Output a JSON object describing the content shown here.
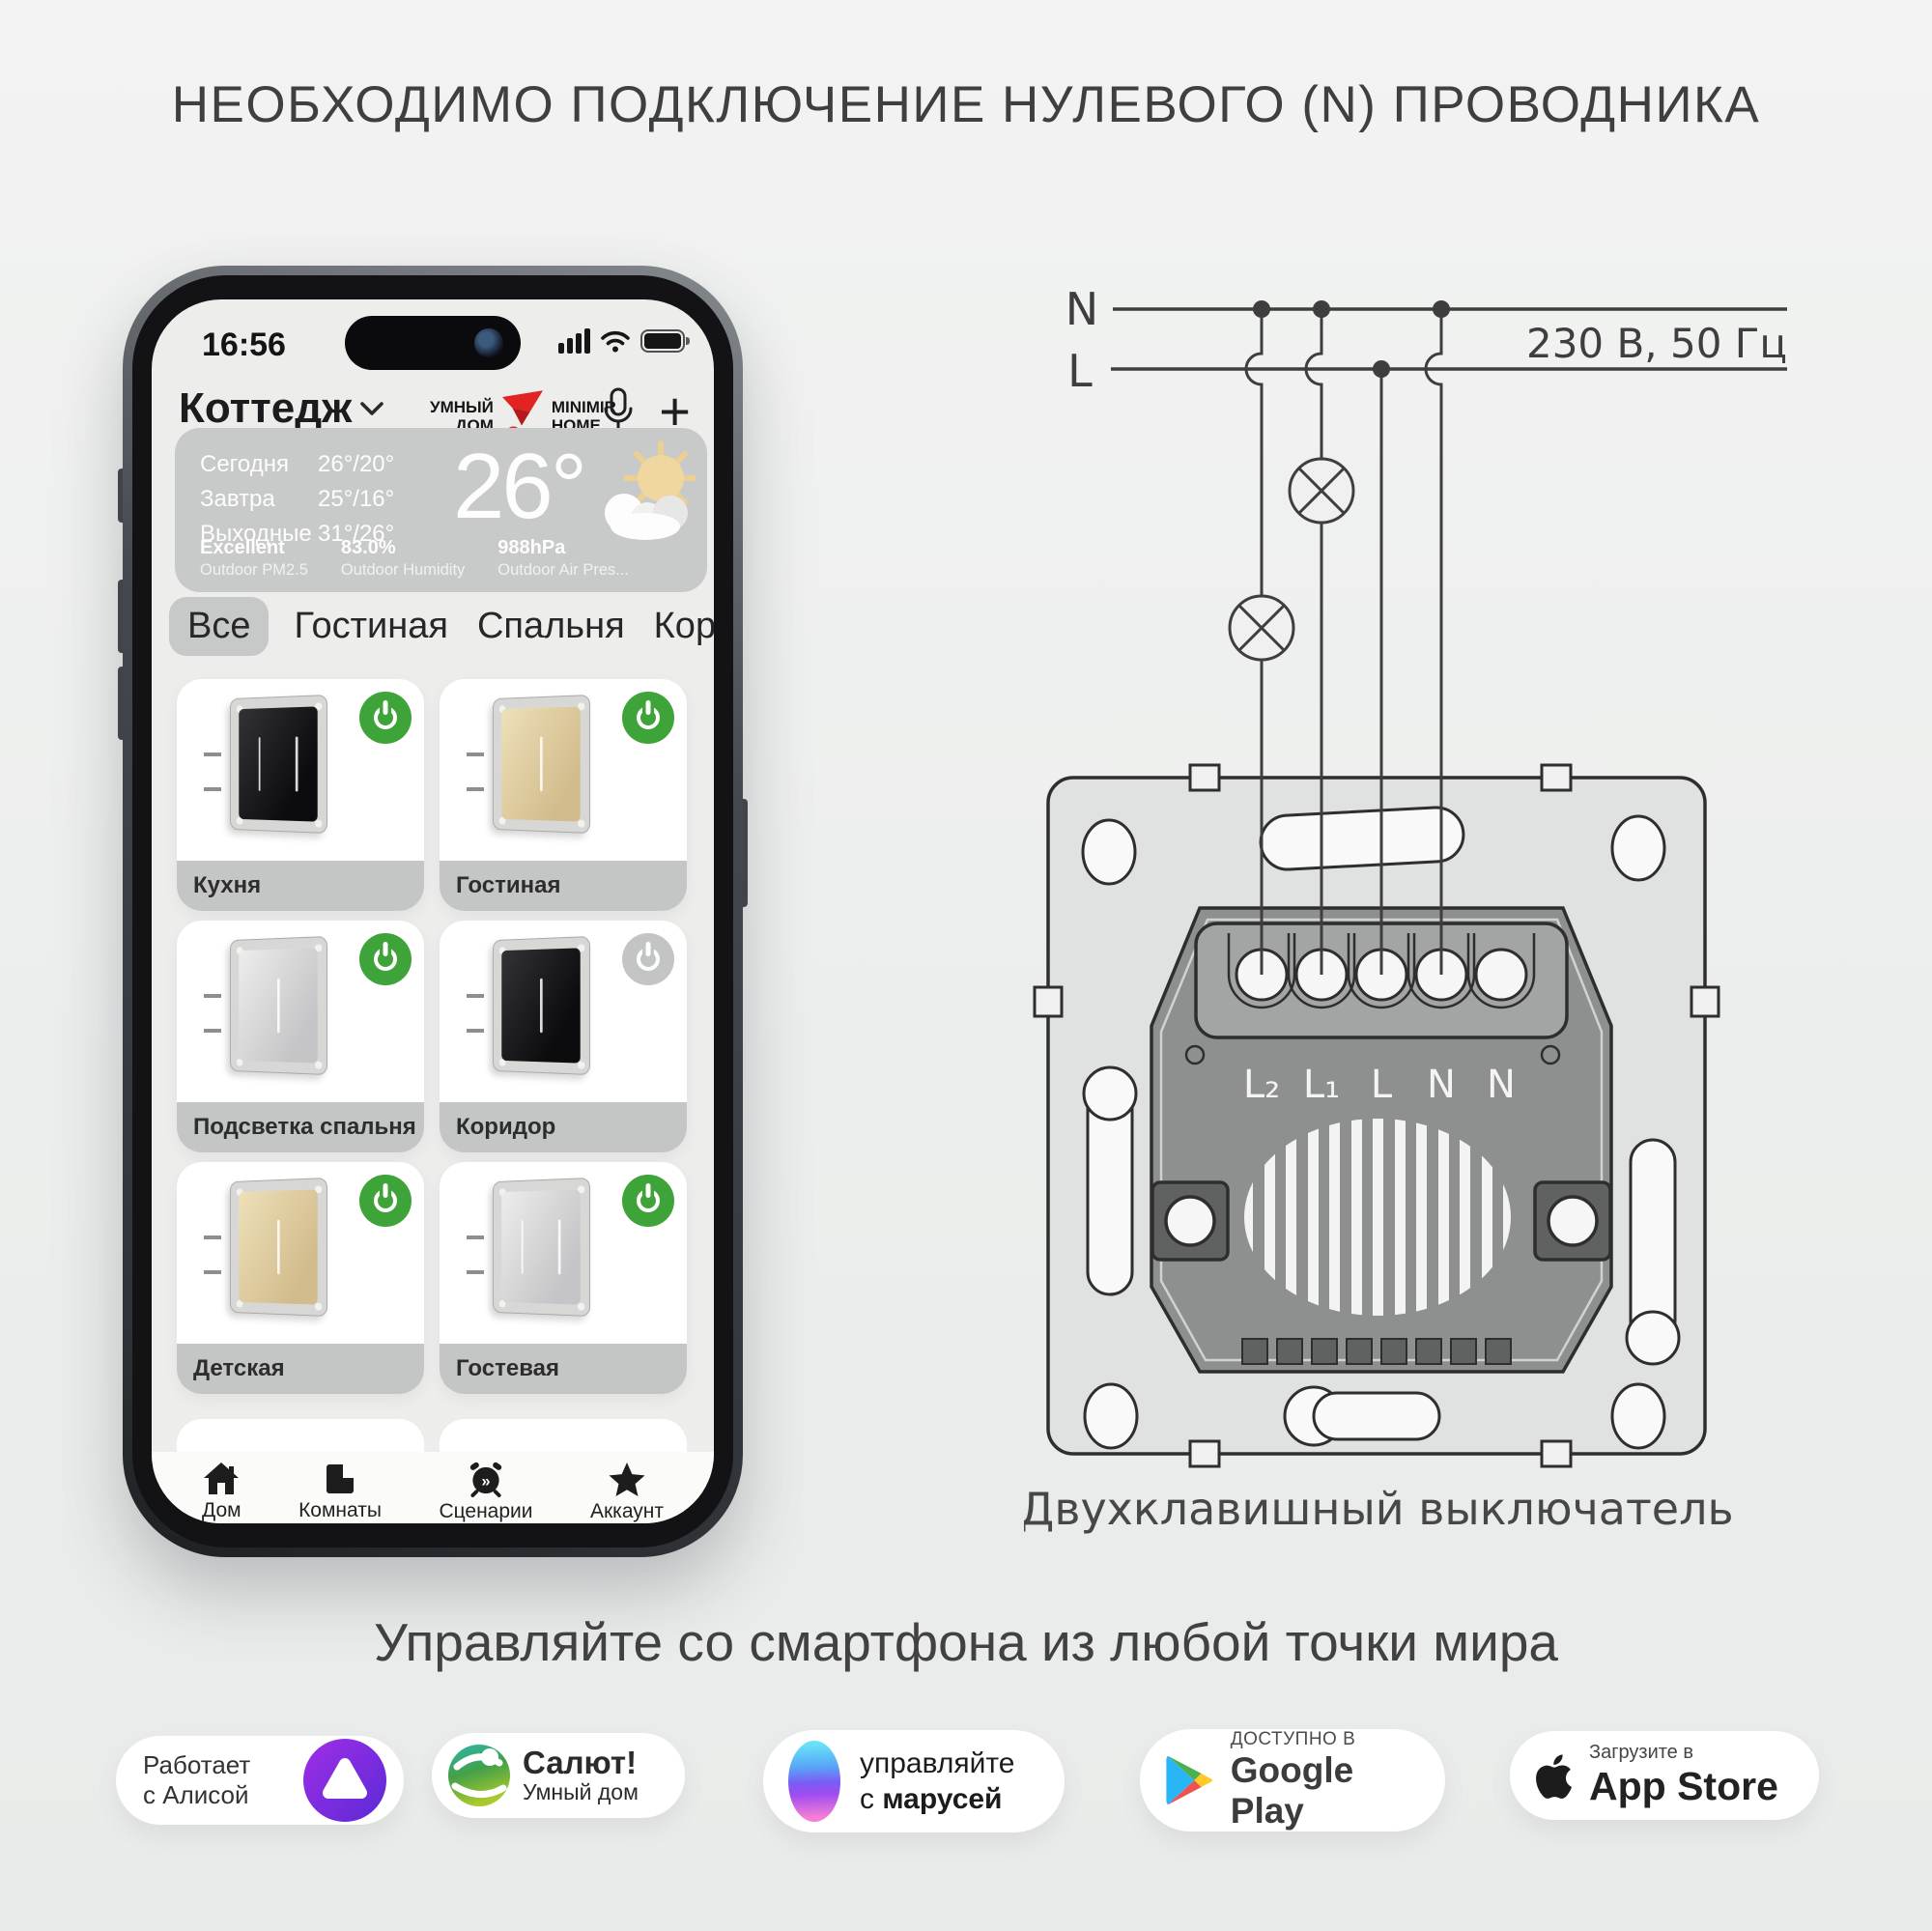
{
  "title": "НЕОБХОДИМО ПОДКЛЮЧЕНИЕ НУЛЕВОГО (N) ПРОВОДНИКА",
  "phone": {
    "status": {
      "time": "16:56"
    },
    "header": {
      "location": "Коттедж",
      "brand_left_1": "УМНЫЙ",
      "brand_left_2": "ДОМ",
      "brand_right_1": "MINIMIR",
      "brand_right_2": "HOME",
      "add_icon": "+"
    },
    "weather": {
      "forecast": [
        {
          "label": "Сегодня",
          "temp": "26°/20°"
        },
        {
          "label": "Завтра",
          "temp": "25°/16°"
        },
        {
          "label": "Выходные",
          "temp": "31°/26°"
        }
      ],
      "current_temp": "26°",
      "stats": [
        {
          "value": "Excellent",
          "label": "Outdoor PM2.5"
        },
        {
          "value": "83.0%",
          "label": "Outdoor Humidity"
        },
        {
          "value": "988hPa",
          "label": "Outdoor Air Pres..."
        }
      ]
    },
    "tabs": [
      {
        "label": "Все"
      },
      {
        "label": "Гостиная"
      },
      {
        "label": "Спальня"
      },
      {
        "label": "Коридор"
      }
    ],
    "devices": [
      {
        "name": "Кухня",
        "color": "black",
        "state": "on",
        "lines": "2"
      },
      {
        "name": "Гостиная",
        "color": "gold",
        "state": "on",
        "lines": "1"
      },
      {
        "name": "Подсветка спальня",
        "color": "silver",
        "state": "on",
        "lines": "1"
      },
      {
        "name": "Коридор",
        "color": "black",
        "state": "off",
        "lines": "1"
      },
      {
        "name": "Детская",
        "color": "gold",
        "state": "on",
        "lines": "1"
      },
      {
        "name": "Гостевая",
        "color": "silver",
        "state": "on",
        "lines": "2"
      }
    ],
    "nav": [
      {
        "label": "Дом"
      },
      {
        "label": "Комнаты"
      },
      {
        "label": "Сценарии"
      },
      {
        "label": "Аккаунт"
      }
    ]
  },
  "diagram": {
    "n_label": "N",
    "l_label": "L",
    "voltage": "230 В, 50 Гц",
    "terminals": [
      "L₂",
      "L₁",
      "L",
      "N",
      "N"
    ],
    "caption": "Двухклавишный выключатель"
  },
  "headline": "Управляйте со смартфона из любой точки мира",
  "badges": {
    "alisa": {
      "line1": "Работает",
      "line2": "с Алисой"
    },
    "salut": {
      "title": "Салют!",
      "subtitle": "Умный дом"
    },
    "marusia": {
      "line1": "управляйте",
      "line2_prefix": "с ",
      "line2_bold": "марусей"
    },
    "google_play": {
      "small": "ДОСТУПНО В",
      "big": "Google Play"
    },
    "app_store": {
      "small": "Загрузите в",
      "big": "App Store"
    }
  },
  "colors": {
    "accent_green": "#3ea339",
    "off_gray": "#c3c5c4",
    "brand_red": "#e32222"
  }
}
